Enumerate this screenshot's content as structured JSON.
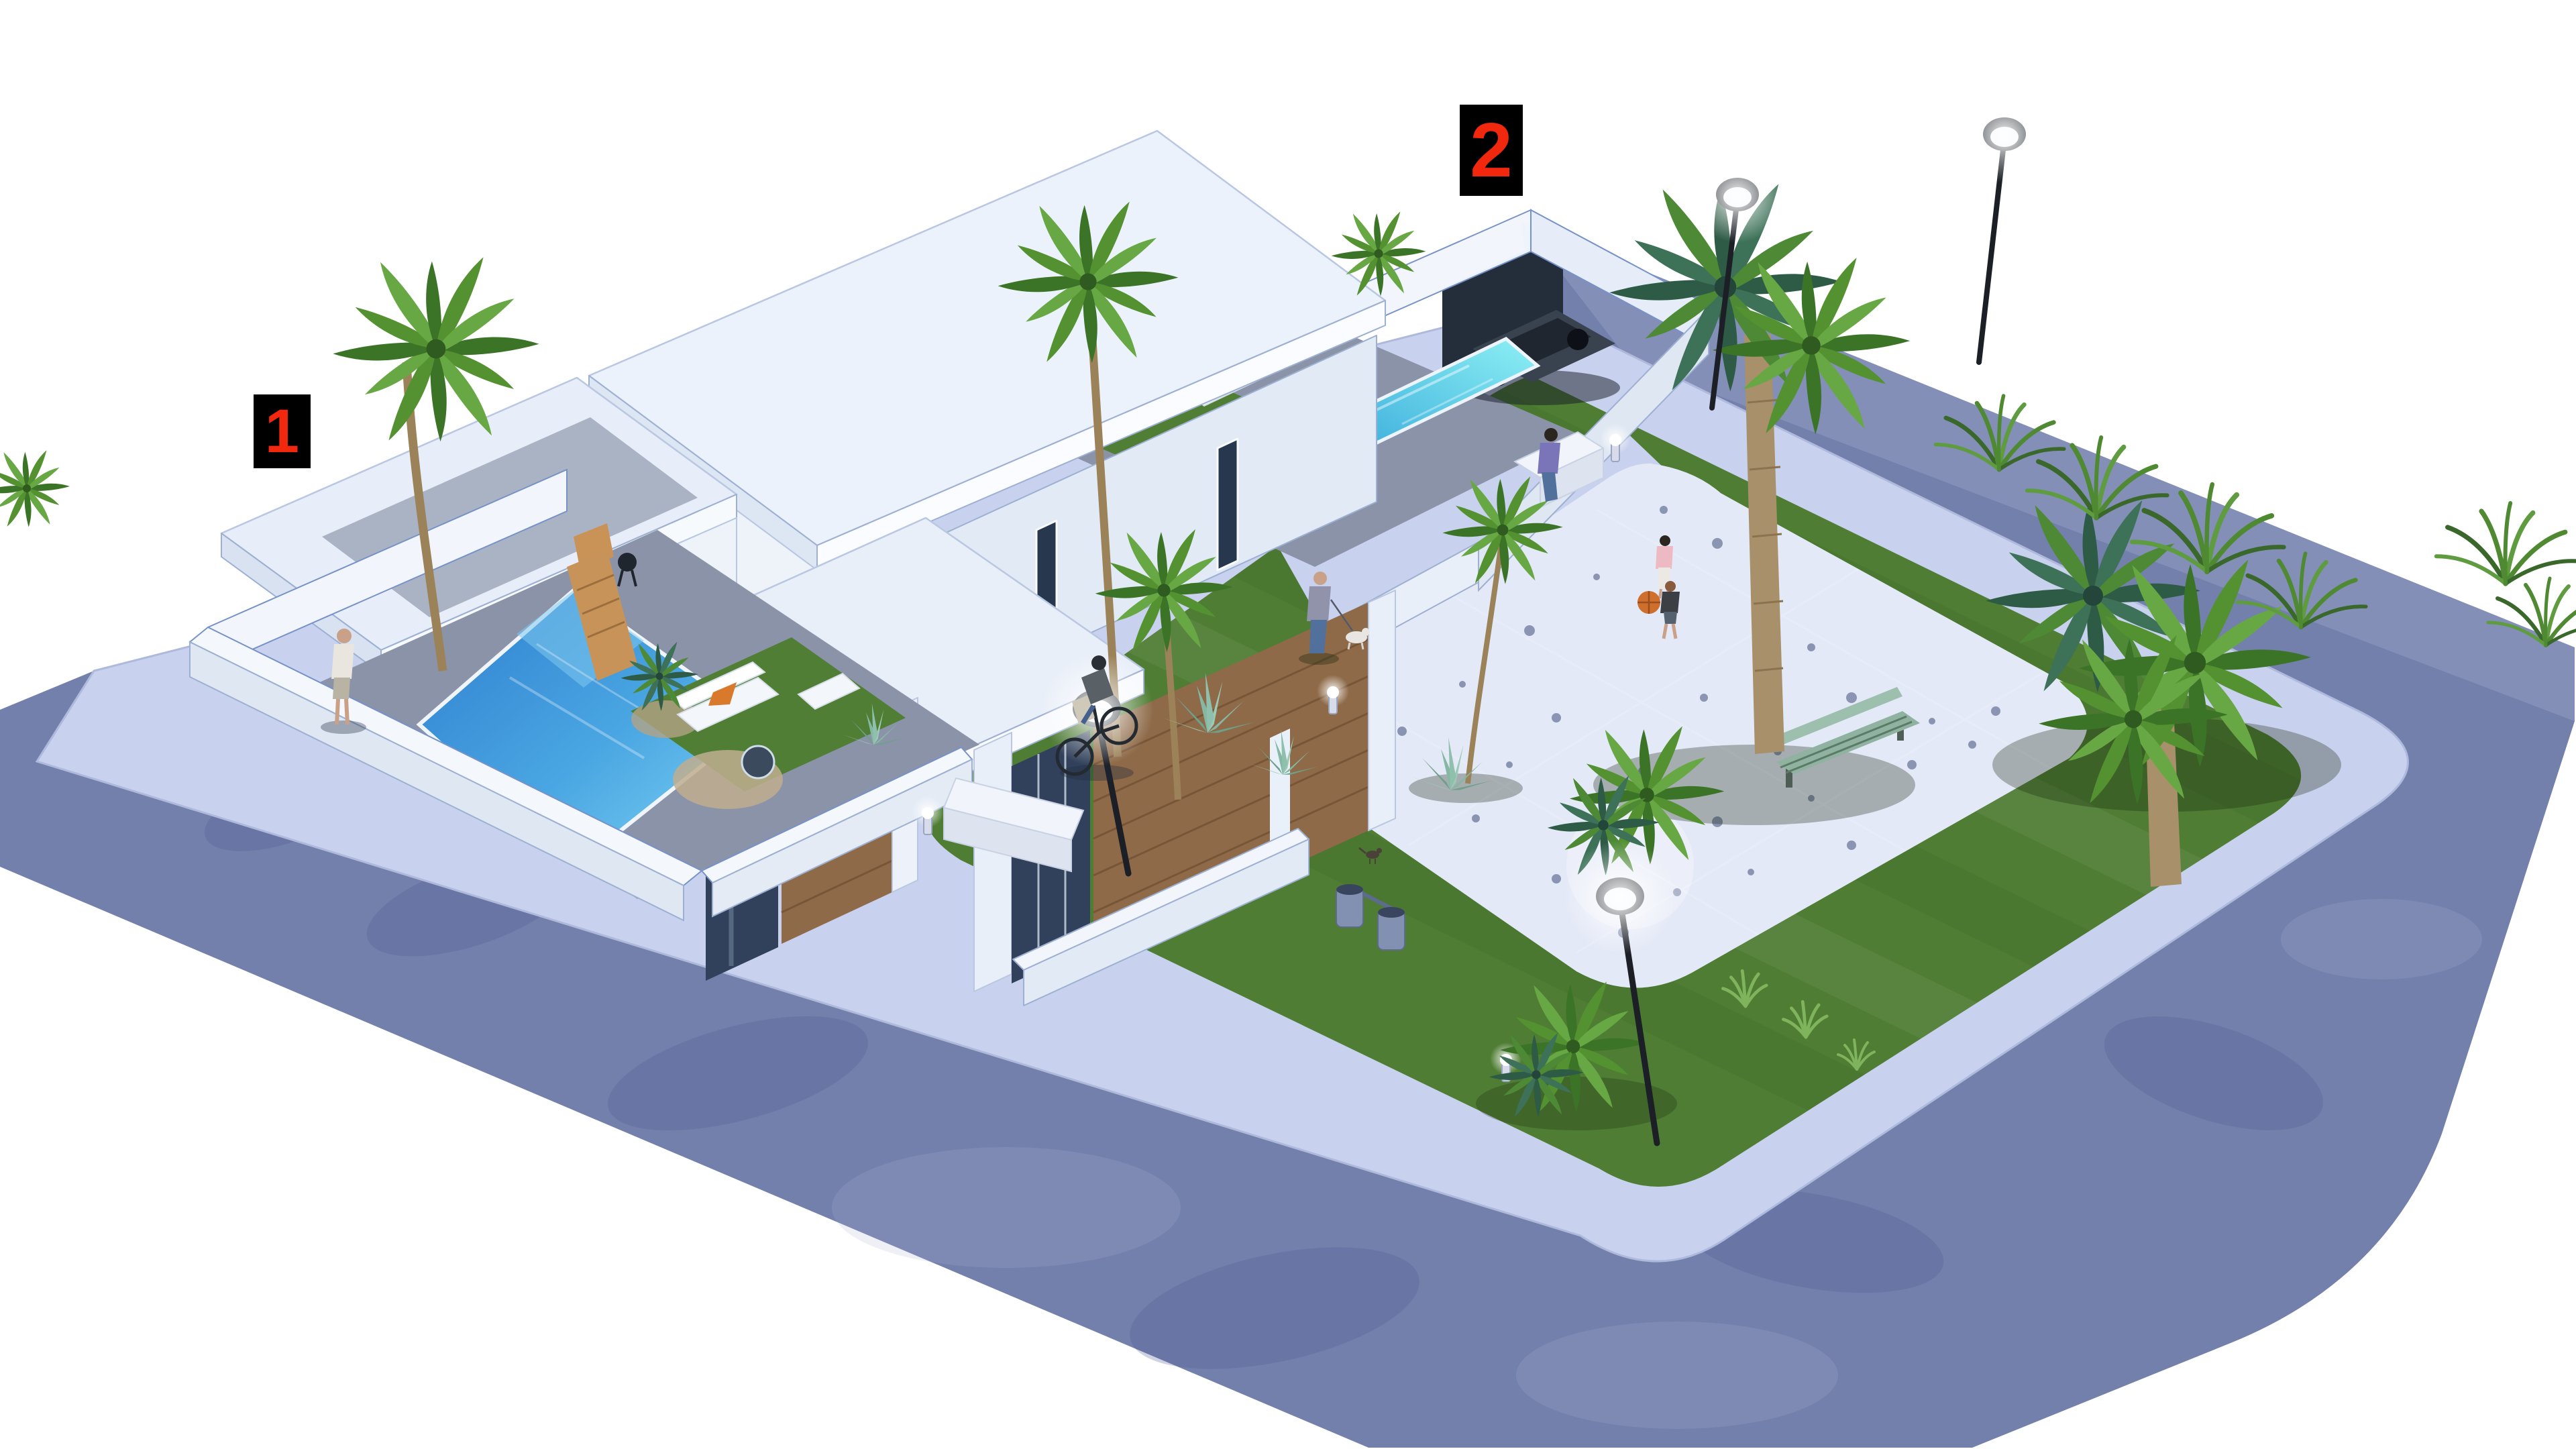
{
  "page": {
    "background": "#ffffff",
    "render_style": "photorealistic 3D visualization, aerial isometric view",
    "description": "Aerial 3D architectural rendering of a modern white duplex villa plot with two private pools, next to a landscaped corner park with a white gravel plaza, palm trees, benches and street lamps, surrounded by blue-gray streets with light sidewalks"
  },
  "markers": [
    {
      "id": "marker-1",
      "label": "1",
      "number_color": "#f1270e",
      "box_color": "#000000",
      "placement": "upper-left, beside the left villa with the blue front pool"
    },
    {
      "id": "marker-2",
      "label": "2",
      "number_color": "#f1270e",
      "box_color": "#000000",
      "placement": "top-center, above the right villa back wall near the carport"
    }
  ],
  "scene": {
    "villas": {
      "count": 2,
      "style": "white flat-roof modern duplex with wood-clad accents and glass doors"
    },
    "pools": [
      {
        "name": "villa-1 front pool",
        "color_hint": "deep blue"
      },
      {
        "name": "villa-2 back plunge pool",
        "color_hint": "turquoise"
      }
    ],
    "park": {
      "lawn": "large green lawn with mowing stripes",
      "plaza": "white speckled gravel plaza with rounded corners",
      "furniture": [
        "long white stone bench",
        "white bench with seated person",
        "green slatted bench under large palm",
        "twin litter bins",
        "glowing bollard lights"
      ]
    },
    "vegetation": [
      "tall curved palm by villa 1",
      "tall palm in front of facade",
      "large twin-crown palm in park",
      "fan palm cluster at park right",
      "palm shrubs on gravel plaza",
      "agaves",
      "ferns along top street edge",
      "grass tufts"
    ],
    "street_lamps": 4,
    "people": [
      "pedestrian standing on left sidewalk",
      "cyclist riding on promenade",
      "man walking a small dog",
      "person sitting on white bench",
      "woman strolling on gravel plaza",
      "boy playing with a basketball"
    ],
    "animals": [
      "small white dog on leash",
      "bird on gravel"
    ],
    "vehicles": [
      "dark car parked in villa-2 carport"
    ]
  },
  "palette": {
    "street": "#7380ac",
    "street_light": "#97a2c6",
    "street_dark": "#515e92",
    "sidewalk": "#c8d1ed",
    "park_lawn": "#4e7d33",
    "private_lawn": "#507e35",
    "gravel": "#e4e9f7",
    "gravel_speckle": "#31426f",
    "roof_white": "#ecf2fb",
    "wall_white": "#f2f6fc",
    "wall_shade": "#dfe7f3",
    "wood": "#8e6a48",
    "glass": "#32415b",
    "patio": "#8b93a8",
    "pool_deep": "#2e7ece",
    "pool_light": "#7fd4f4",
    "pool_turquoise": "#8df0f4",
    "palm_green": "#4f8a33",
    "trunk": "#9b8259",
    "marker_red": "#f1270e",
    "marker_black": "#000000"
  }
}
